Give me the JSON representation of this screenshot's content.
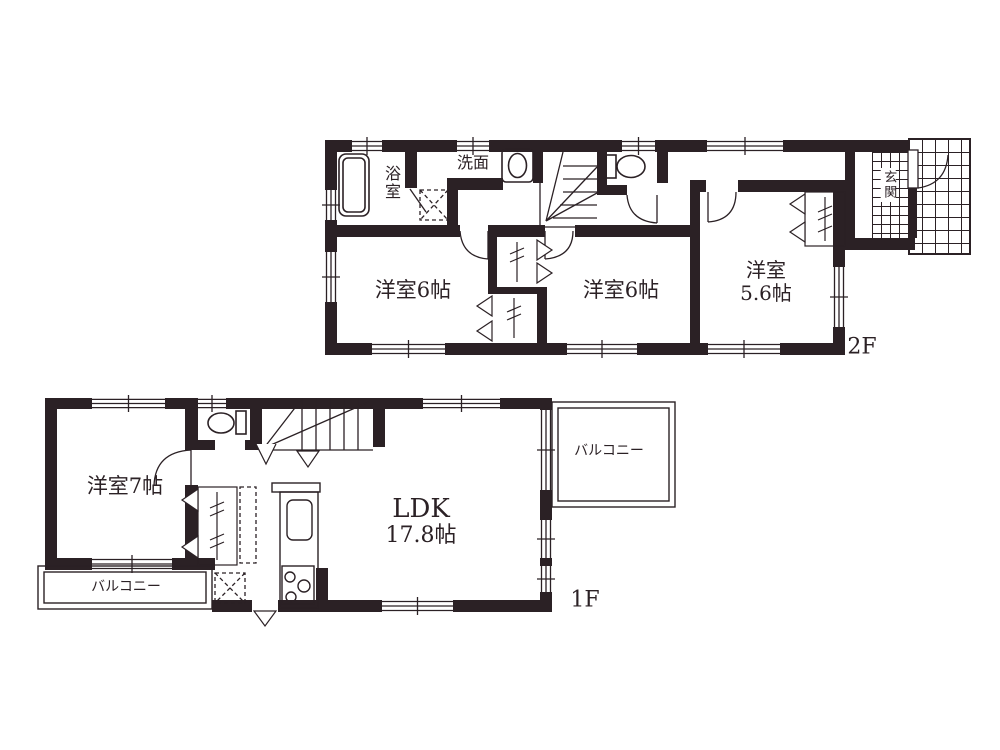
{
  "colors": {
    "ink": "#2b2125",
    "paper": "#ffffff"
  },
  "floor_2f": {
    "label": "2F",
    "rooms": {
      "bath": "浴室",
      "washroom": "洗面",
      "entrance": "玄関",
      "bedroom_a": "洋室6帖",
      "bedroom_b": "洋室6帖",
      "bedroom_c": {
        "name": "洋室",
        "size": "5.6帖"
      }
    }
  },
  "floor_1f": {
    "label": "1F",
    "rooms": {
      "bedroom": "洋室7帖",
      "ldk": {
        "name": "LDK",
        "size": "17.8帖"
      },
      "balcony_side": "バルコニー",
      "balcony_front": "バルコニー"
    }
  }
}
